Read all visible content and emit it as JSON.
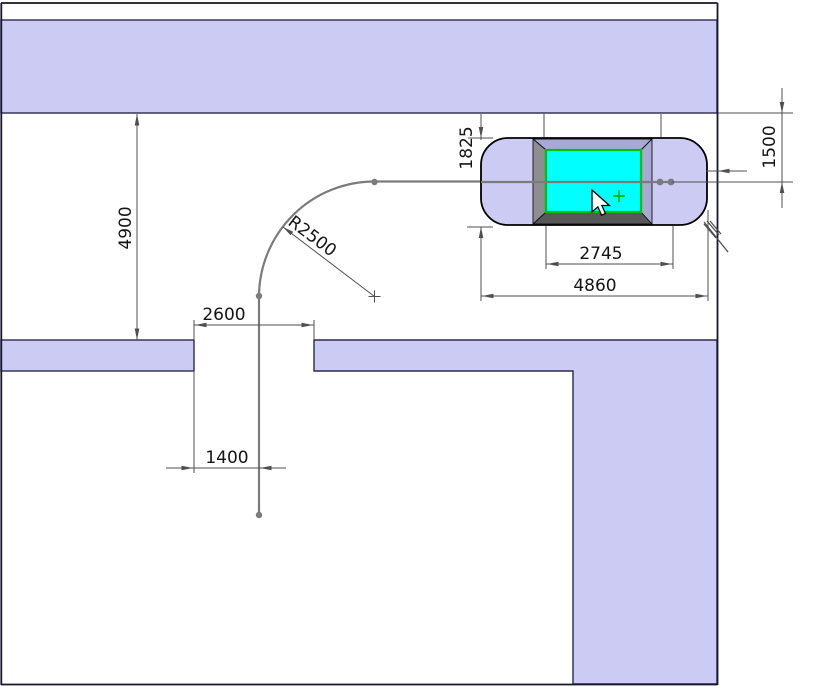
{
  "drawing": {
    "type": "cad-top-view-vehicle-turning-clearance",
    "dimensions": {
      "corridor_height": {
        "label": "4900"
      },
      "gap_width": {
        "label": "2600"
      },
      "lane_offset": {
        "label": "1400"
      },
      "turn_radius": {
        "label": "R2500"
      },
      "car_width": {
        "label": "1825"
      },
      "wheelbase": {
        "label": "2745"
      },
      "car_length": {
        "label": "4860"
      },
      "wall_clearance": {
        "label": "1500"
      }
    },
    "colors": {
      "wall_fill": "#cbcbf4",
      "wall_edge": "#2b2b52",
      "car_fill": "#cbcbf4",
      "cabin_top": "#a7a8d4",
      "cabin_bottom": "#585858",
      "cabin_side": "#8e8e92",
      "cabin_right": "#a7a8d4",
      "roof_fill": "#00ffff",
      "roof_edge": "#00c000",
      "path_color": "#7b7b7b",
      "dim_color": "#4f4f4f",
      "marker_green": "#00b400",
      "cursor_fill": "#ffffff"
    }
  }
}
